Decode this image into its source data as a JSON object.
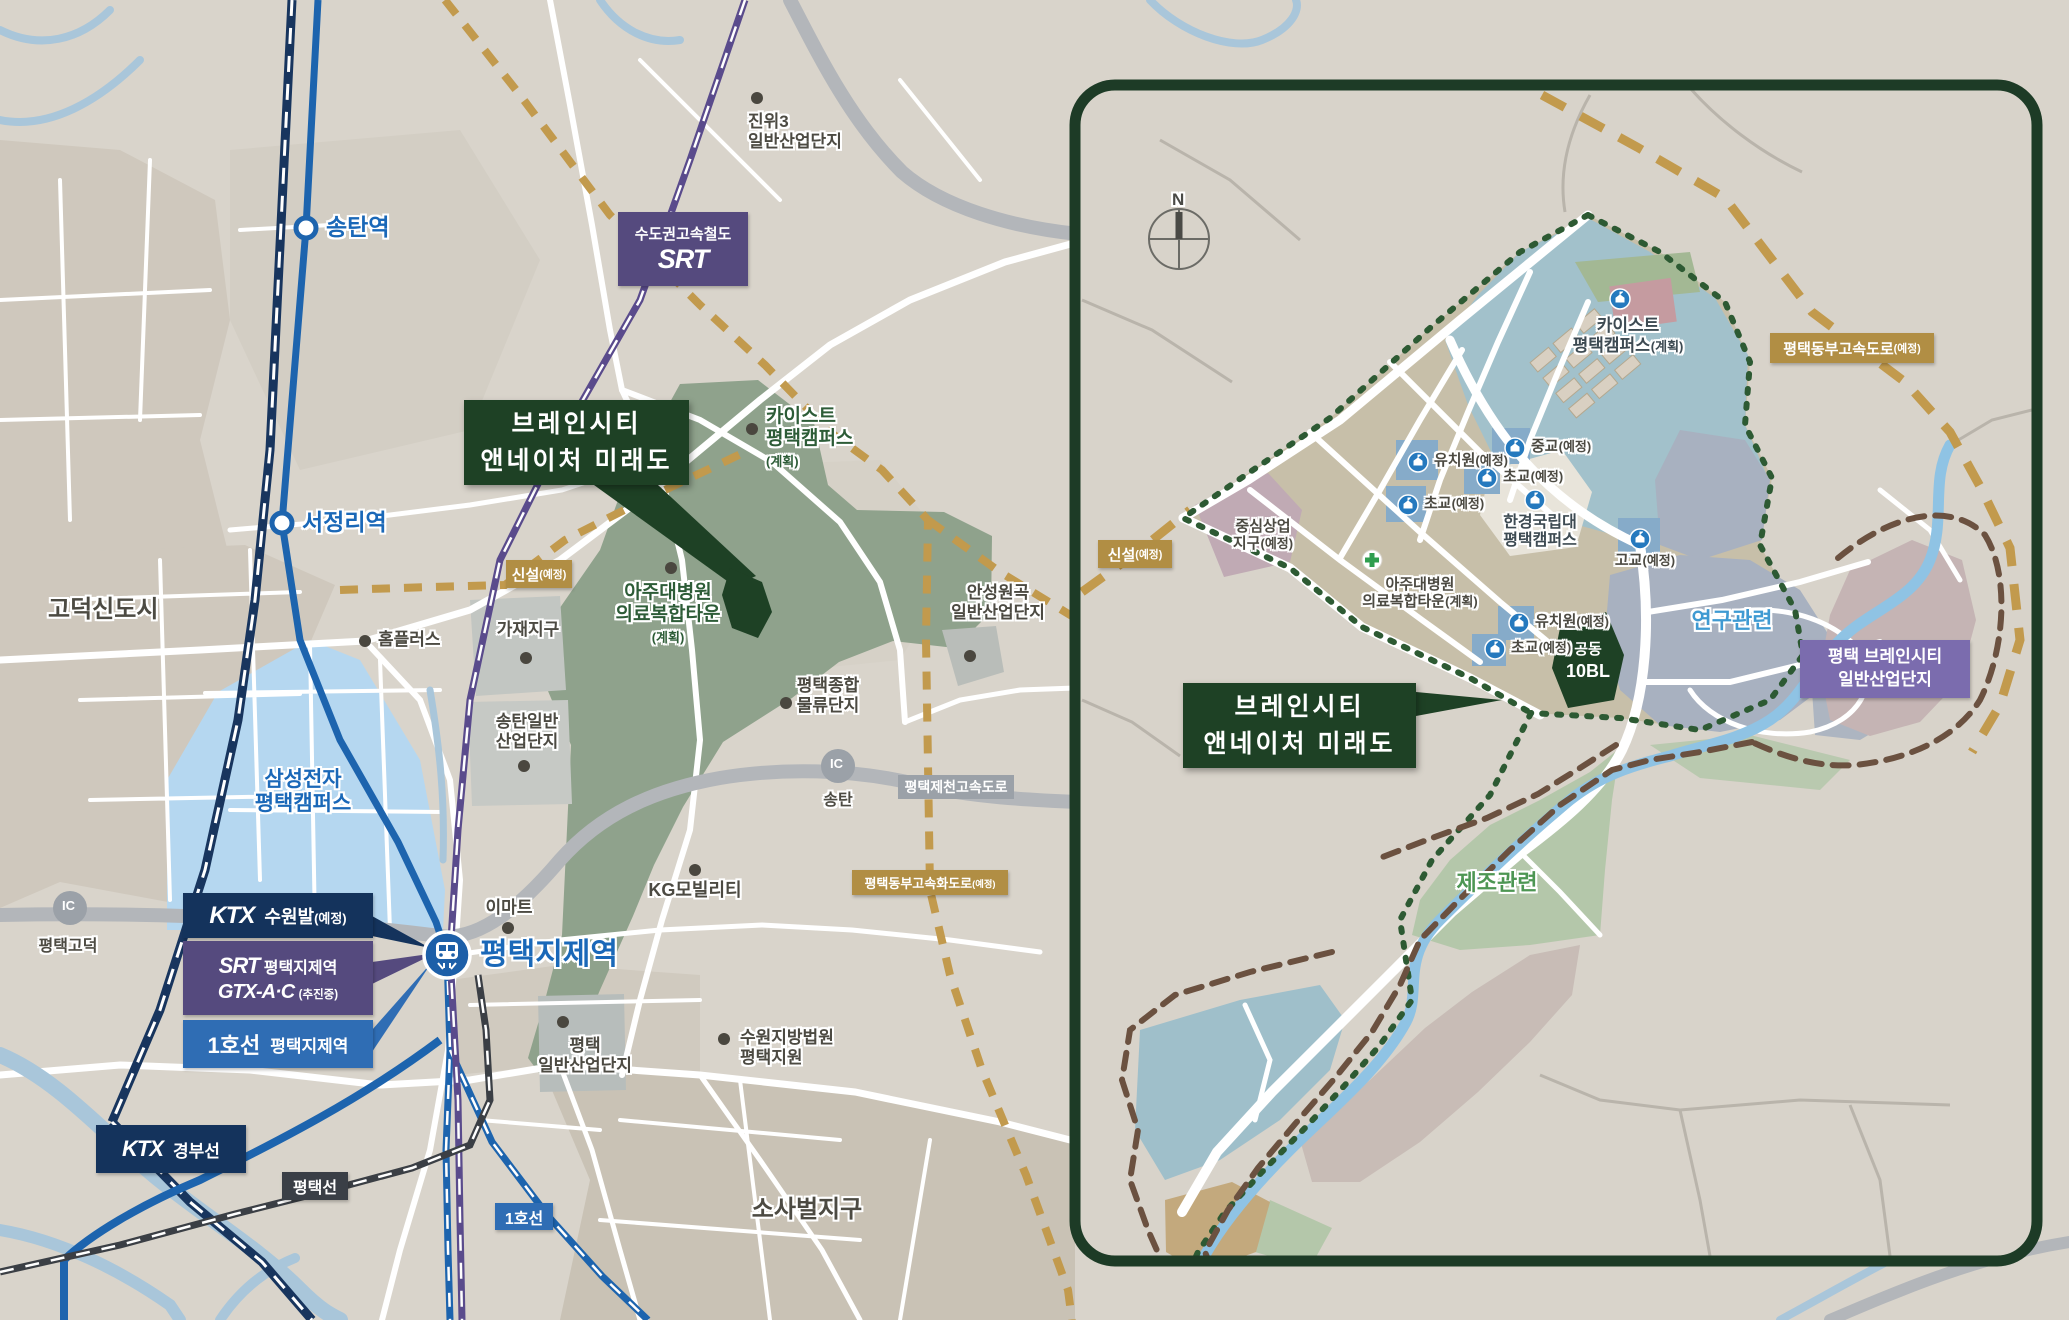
{
  "left_map": {
    "callout": {
      "line1": "브레인시티",
      "line2": "앤네이처 미래도"
    },
    "stations": {
      "songtan": "송탄역",
      "seojeongni": "서정리역",
      "jeje": "평택지제역"
    },
    "srt_badge": {
      "line1": "수도권고속철도",
      "logo": "SRT"
    },
    "rail_badges": {
      "ktx_suwon": {
        "logo": "KTX",
        "label": "수원발",
        "suffix": "(예정)"
      },
      "srt": {
        "logo": "SRT",
        "label": "평택지제역"
      },
      "gtx": {
        "logo": "GTX-A·C",
        "suffix": "(추진중)"
      },
      "line1": {
        "logo": "1호선",
        "label": "평택지제역"
      },
      "ktx_gyeongbu": {
        "logo": "KTX",
        "label": "경부선"
      },
      "pyeongtaek_line": "평택선",
      "line1_short": "1호선"
    },
    "road_badges": {
      "sinseol": {
        "label": "신설",
        "suffix": "(예정)"
      },
      "jecheon_expwy": "평택제천고속도로",
      "east_expwy": {
        "label": "평택동부고속화도로",
        "suffix": "(예정)"
      },
      "ic": "IC",
      "ic_godeok": "평택고덕",
      "ic_songtan": "송탄"
    },
    "places": {
      "jinwi3": [
        "진위3",
        "일반산업단지"
      ],
      "kaist": [
        "카이스트",
        "평택캠퍼스",
        "(계획)"
      ],
      "ajou": [
        "아주대병원",
        "의료복합타운",
        "(계획)"
      ],
      "godeok_city": "고덕신도시",
      "homeplus": "홈플러스",
      "gajae": "가재지구",
      "songtan_ind": [
        "송탄일반",
        "산업단지"
      ],
      "samsung": [
        "삼성전자",
        "평택캠퍼스"
      ],
      "logistics": [
        "평택종합",
        "물류단지"
      ],
      "anseong": [
        "안성원곡",
        "일반산업단지"
      ],
      "kg": "KG모빌리티",
      "emart": "이마트",
      "pt_ind": [
        "평택",
        "일반산업단지"
      ],
      "court": [
        "수원지방법원",
        "평택지원"
      ],
      "sosabeol": "소사벌지구"
    }
  },
  "inset": {
    "compass": "N",
    "callout": {
      "line1": "브레인시티",
      "line2": "앤네이처 미래도"
    },
    "kaist": {
      "line1": "카이스트",
      "line2": "평택캠퍼스",
      "suffix": "(계획)"
    },
    "facilities": {
      "kinder1": {
        "label": "유치원",
        "suffix": "(예정)"
      },
      "elem1": {
        "label": "초교",
        "suffix": "(예정)"
      },
      "mid1": {
        "label": "중교",
        "suffix": "(예정)"
      },
      "elem2": {
        "label": "초교",
        "suffix": "(예정)"
      },
      "hankyong": [
        "한경국립대",
        "평택캠퍼스"
      ],
      "high1": {
        "label": "고교",
        "suffix": "(예정)"
      },
      "ajou": {
        "line1": "아주대병원",
        "line2": "의료복합타운",
        "suffix": "(계획)"
      },
      "kinder2": {
        "label": "유치원",
        "suffix": "(예정)"
      },
      "elem3": {
        "label": "초교",
        "suffix": "(예정)"
      },
      "commercial": {
        "line1": "중심상업",
        "line2": "지구",
        "suffix": "(예정)"
      }
    },
    "site_block": {
      "line1": "공동",
      "line2": "10BL"
    },
    "zones": {
      "research": "연구관련",
      "manufacturing": "제조관련"
    },
    "industrial_badge": [
      "평택 브레인시티",
      "일반산업단지"
    ],
    "highway_badge": {
      "label": "평택동부고속도로",
      "suffix": "(예정)"
    },
    "sinseol_badge": {
      "label": "신설",
      "suffix": "(예정)"
    }
  }
}
